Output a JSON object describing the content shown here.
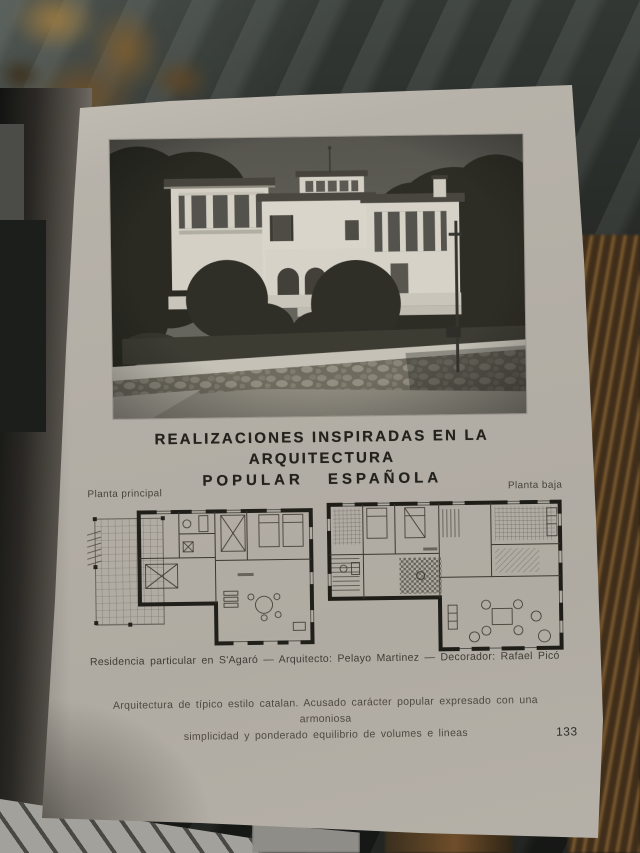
{
  "page": {
    "title_line1": "REALIZACIONES INSPIRADAS EN LA ARQUITECTURA",
    "title_line2": "POPULAR ESPAÑOLA",
    "page_number": "133"
  },
  "plans": {
    "left_label": "Planta principal",
    "right_label": "Planta baja"
  },
  "captions": {
    "credit": "Residencia particular en S'Agaró — Arquitecto: Pelayo Martinez — Decorador: Rafael Picó",
    "description_line1": "Arquitectura de típico estilo catalan. Acusado carácter popular expresado con una armoniosa",
    "description_line2": "simplicidad y ponderado equilibrio de volumes e lineas"
  },
  "colors": {
    "paper": "#b3aea5",
    "title_ink": "#24221c",
    "caption_ink": "#3f3c35",
    "backdrop": "#2d312e",
    "fore_edge_brown": "#6d4f2c",
    "photo_sky": "#57564f",
    "photo_foliage": "#2b2a22",
    "photo_wall_white": "#d7d3c8"
  }
}
